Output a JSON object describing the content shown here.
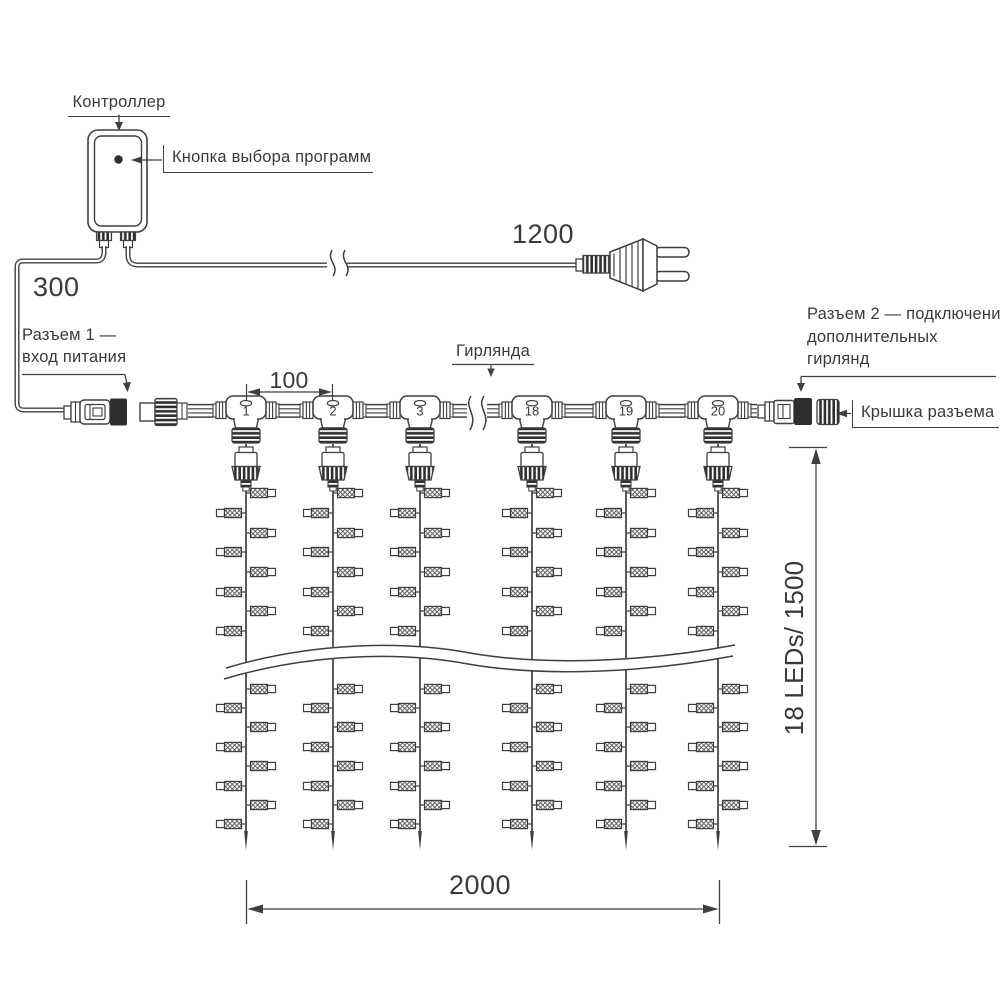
{
  "labels": {
    "controller": "Контроллер",
    "program_button": "Кнопка выбора программ",
    "connector1_lines": [
      "Разъем 1 —",
      "вход питания"
    ],
    "garland": "Гирлянда",
    "connector2_lines": [
      "Разъем 2 — подключение",
      "дополнительных",
      "гирлянд"
    ],
    "connector_cap": "Крышка разъема"
  },
  "dimensions": {
    "lead_wire_mm": "300",
    "power_cord_mm": "1200",
    "drop_spacing_mm": "100",
    "curtain_width_mm": "2000",
    "curtain_height": "18 LEDs/ 1500"
  },
  "drops": [
    "1",
    "2",
    "3",
    "18",
    "19",
    "20"
  ]
}
